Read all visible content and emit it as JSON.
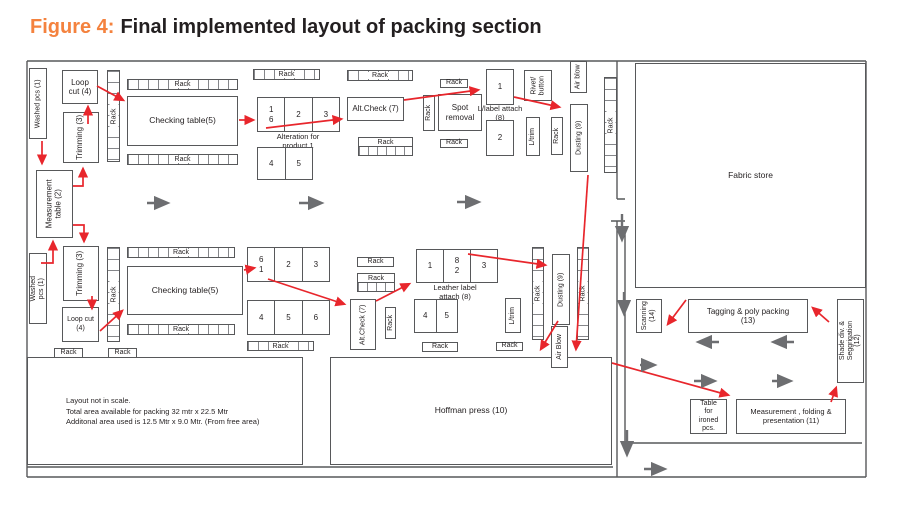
{
  "title": {
    "figure": "Figure 4:",
    "text": "Final implemented layout of packing section"
  },
  "labels": {
    "rack": "Rack",
    "washed_pcs": "Washed pcs (1)",
    "loop_cut": "Loop cut (4)",
    "trimming": "Trimming (3)",
    "measurement_table": "Measurement table (2)",
    "checking_table": "Checking table(5)",
    "alteration_caption": "Alteration for product 1",
    "alt_check": "Alt.Check (7)",
    "spot_removal": "Spot removal",
    "llabel_caption": "L/label attach (8)",
    "rivet_button": "Rivet/ button",
    "air_blow_top": "Air blow",
    "air_blow_bottom": "Air Blow",
    "l_trim": "L/trim",
    "dusting": "Dusting (9)",
    "fabric_store": "Fabric store",
    "leather_caption": "Leather label attach (8)",
    "hoffman": "Hoffman press (10)",
    "scanning": "Scanning (14)",
    "tagging": "Tagging & poly packing (13)",
    "shade": "Shade div. & Seggrigation (12)",
    "table_ironed": "Table for ironed pcs.",
    "measurement_folding": "Measurement , folding & presentation (11)"
  },
  "cells": {
    "alt_top": [
      "1",
      "6",
      "2",
      "3"
    ],
    "alt_bottom": [
      "4",
      "5"
    ],
    "chk2_top": [
      "6",
      "1",
      "2",
      "3"
    ],
    "chk2_bottom": [
      "4",
      "5",
      "6"
    ],
    "leather_top": [
      "1",
      "8",
      "2",
      "3"
    ],
    "leather_bottom": [
      "4",
      "5"
    ]
  },
  "note": {
    "line1": "Layout not in scale.",
    "line2": "Total area available for packing 32 mtr x 22.5 Mtr",
    "line3": "Additonal area used is 12.5 Mtr x 9.0 Mtr. (From free area)"
  },
  "colors": {
    "figure_accent": "#f4823e",
    "flow_red": "#e8262c",
    "arrow_gray": "#6d6e71",
    "wall_line": "#57585a"
  }
}
